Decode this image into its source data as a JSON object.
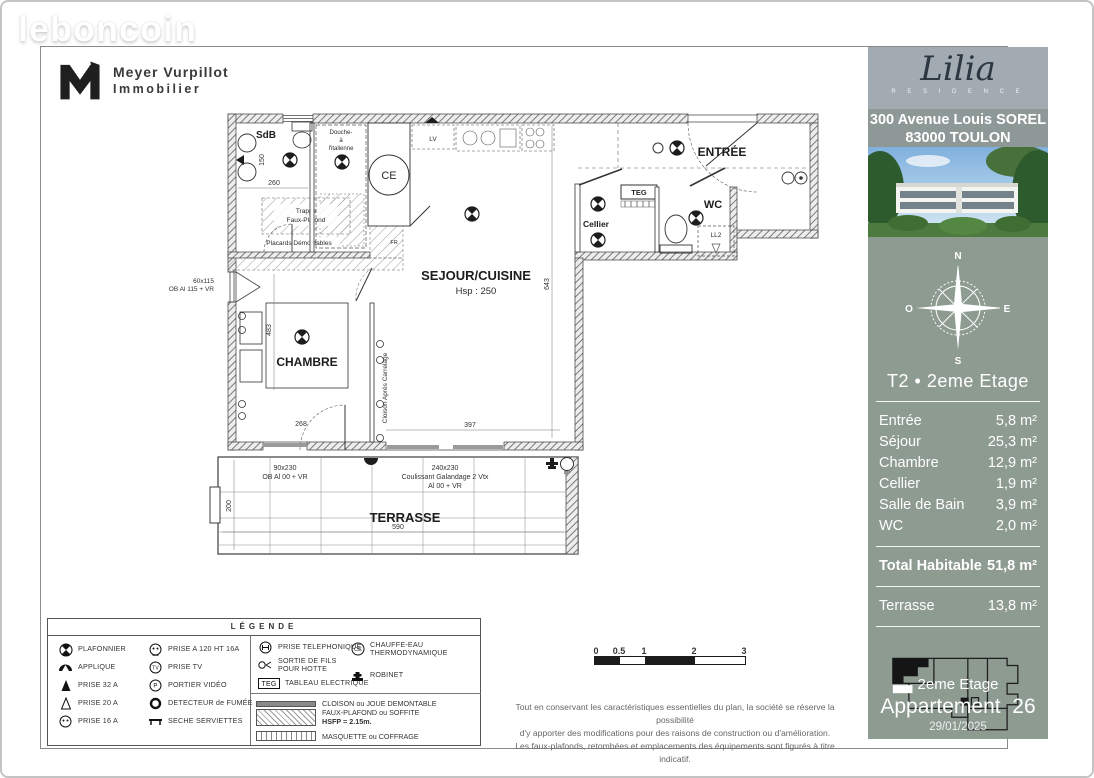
{
  "watermark": "leboncoin",
  "agency": {
    "line1": "Meyer Vurpillot",
    "line2": "Immobilier"
  },
  "sidebar": {
    "residence_name": "Lilia",
    "residence_subtitle": "R E S I D E N C E",
    "address1": "300 Avenue Louis SOREL",
    "address2": "83000 TOULON",
    "compass": {
      "n": "N",
      "e": "E",
      "s": "S",
      "o": "O"
    },
    "unit_title": "T2 • 2eme Etage",
    "areas": [
      {
        "label": "Entrée",
        "value": "5,8 m²"
      },
      {
        "label": "Séjour",
        "value": "25,3 m²"
      },
      {
        "label": "Chambre",
        "value": "12,9 m²"
      },
      {
        "label": "Cellier",
        "value": "1,9 m²"
      },
      {
        "label": "Salle de Bain",
        "value": "3,9 m²"
      },
      {
        "label": "WC",
        "value": "2,0 m²"
      }
    ],
    "total_label": "Total Habitable",
    "total_value": "51,8 m²",
    "terrace_label": "Terrasse",
    "terrace_value": "13,8 m²",
    "footer_floor": "2eme Etage",
    "footer_apartment": "Appartement  26",
    "footer_date": "29/01/2025"
  },
  "plan": {
    "rooms": {
      "sdb": "SdB",
      "douche1": "Douche-",
      "douche2": "à",
      "douche3": "l'italienne",
      "entree": "ENTRÉE",
      "wc": "WC",
      "cellier": "Cellier",
      "sejour": "SEJOUR/CUISINE",
      "hsp": "Hsp : 250",
      "chambre": "CHAMBRE",
      "terrasse": "TERRASSE"
    },
    "labels": {
      "ce": "CE",
      "teg": "TEG",
      "ll2": "LL2",
      "lv": "LV",
      "fr": "FR",
      "ep": "EP",
      "trappe1": "Trappe",
      "trappe2": "Faux-Plafond",
      "placards": "Placards Démontables",
      "cloison": "Cloison Après Carrelage",
      "win_left1": "60x115",
      "win_left2": "OB Al 115 + VR",
      "terr_win1a": "90x230",
      "terr_win1b": "OB Al 00 + VR",
      "terr_win2a": "240x230",
      "terr_win2b": "Coulissant Galandage 2 Vtx",
      "terr_win2c": "Al 00 + VR"
    },
    "dims": {
      "sdb_w": "260",
      "sdb_h": "150",
      "chambre_h": "483",
      "chambre_door": "268",
      "sejour_w": "397",
      "sejour_h": "643",
      "terrasse_d": "200",
      "terrasse_w": "590"
    }
  },
  "legend": {
    "title": "LÉGENDE",
    "items": [
      {
        "icon": "plafonnier-icon",
        "label": "PLAFONNIER"
      },
      {
        "icon": "applique-icon",
        "label": "APPLIQUE"
      },
      {
        "icon": "prise-32a-icon",
        "label": "PRISE 32 A"
      },
      {
        "icon": "prise-20a-icon",
        "label": "PRISE 20 A"
      },
      {
        "icon": "prise-16a-icon",
        "label": "PRISE 16 A"
      },
      {
        "icon": "prise-120-icon",
        "label": "PRISE A 120 HT 16A"
      },
      {
        "icon": "prise-tv-icon",
        "label": "PRISE TV",
        "icon_text": "TV"
      },
      {
        "icon": "portier-video-icon",
        "label": "PORTIER VIDÉO",
        "icon_text": "P"
      },
      {
        "icon": "detecteur-fumee-icon",
        "label": "DETECTEUR de FUMÉE"
      },
      {
        "icon": "seche-serviettes-icon",
        "label": "SECHE SERVIETTES"
      },
      {
        "icon": "prise-telephonique-icon",
        "label": "PRISE TELEPHONIQUE"
      },
      {
        "icon": "sortie-fils-icon",
        "label": "SORTIE DE FILS POUR HOTTE"
      },
      {
        "icon": "teg-icon",
        "label": "TABLEAU ELECTRIQUE",
        "icon_text": "TEG"
      },
      {
        "icon": "chauffe-eau-icon",
        "label": "CHAUFFE-EAU THERMODYNAMIQUE",
        "icon_text": "CE"
      },
      {
        "icon": "robinet-icon",
        "label": "ROBINET"
      }
    ],
    "walls": [
      {
        "swatch": "cloison",
        "label": "CLOISON ou JOUE DEMONTABLE"
      },
      {
        "swatch": "faux-plafond",
        "label": "FAUX-PLAFOND ou SOFFITE",
        "sublabel": "HSFP  = 2.15m."
      },
      {
        "swatch": "masquette",
        "label": "MASQUETTE ou COFFRAGE"
      }
    ]
  },
  "scalebar": {
    "ticks": [
      "0",
      "0.5",
      "1",
      "2",
      "3"
    ]
  },
  "disclaimer": {
    "line1": "Tout en conservant les caractéristiques essentielles du plan, la société se réserve la possibilité",
    "line2": "d'y apporter des modifications pour des raisons de construction ou d'amélioration.",
    "line3": "Les faux-plafonds, retombées et emplacements des équipements sont figurés à titre indicatif."
  },
  "colors": {
    "sidebar_body": "#8d9b91",
    "sidebar_header": "#a2abb1",
    "sidebar_address": "#8e9997",
    "text_on_sidebar": "#ffffff",
    "lilia_text": "#2c3742",
    "plan_line": "#3c3c3c"
  }
}
